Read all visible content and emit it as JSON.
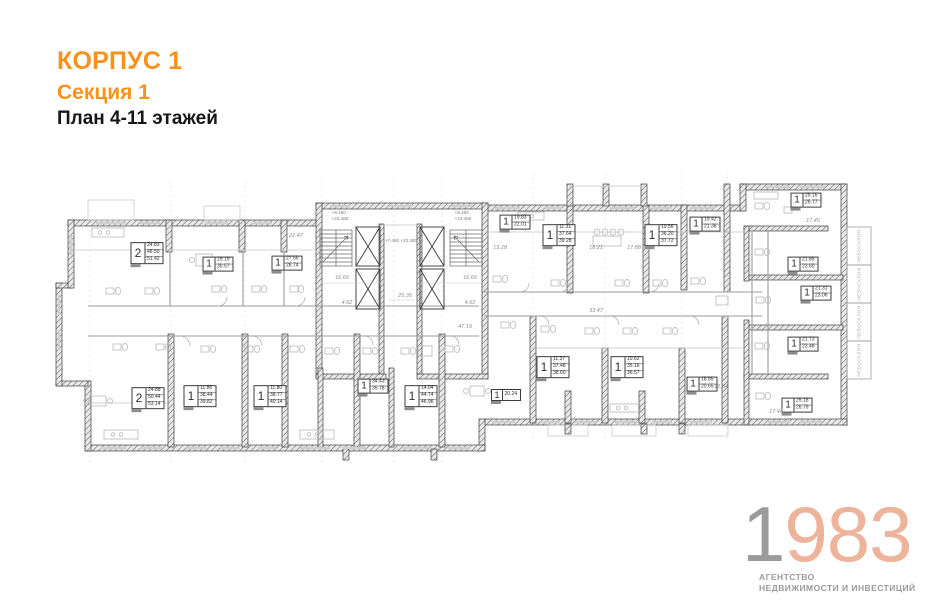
{
  "header": {
    "building": "КОРПУС 1",
    "section": "Секция 1",
    "plan_title": "План 4-11 этажей"
  },
  "logo": {
    "digit_gray": "1",
    "digits_accent": "983",
    "agency_line1": "АГЕНТСТВО",
    "agency_line2": "НЕДВИЖИМОСТИ И ИНВЕСТИЦИЙ"
  },
  "colors": {
    "accent_orange": "#F6921E",
    "logo_peach": "#EDB49B",
    "logo_gray": "#9B9B9B",
    "wall_gray": "#3F3F3F"
  },
  "plan": {
    "apartments": [
      {
        "rooms": "2",
        "areas": [
          "24.83",
          "48.50",
          "51.42"
        ],
        "x": 147,
        "y": 253
      },
      {
        "rooms": "1",
        "areas": [
          "29.19",
          "30.57"
        ],
        "x": 218,
        "y": 264
      },
      {
        "rooms": "1",
        "areas": [
          "27.55",
          "28.74"
        ],
        "x": 287,
        "y": 263
      },
      {
        "rooms": "1",
        "areas": [
          "19.83",
          "22.01"
        ],
        "x": 515,
        "y": 222
      },
      {
        "rooms": "1",
        "areas": [
          "11.31",
          "37.64",
          "39.28"
        ],
        "x": 559,
        "y": 235
      },
      {
        "rooms": "1",
        "areas": [
          "10.56",
          "36.20",
          "37.72"
        ],
        "x": 661,
        "y": 235
      },
      {
        "rooms": "1",
        "areas": [
          "19.42",
          "21.38"
        ],
        "x": 705,
        "y": 224
      },
      {
        "rooms": "1",
        "areas": [
          "25.16",
          "26.77"
        ],
        "x": 806,
        "y": 200
      },
      {
        "rooms": "1",
        "areas": [
          "21.85",
          "23.60"
        ],
        "x": 803,
        "y": 264
      },
      {
        "rooms": "1",
        "areas": [
          "21.31",
          "23.06"
        ],
        "x": 816,
        "y": 293
      },
      {
        "rooms": "1",
        "areas": [
          "21.73",
          "23.48"
        ],
        "x": 803,
        "y": 344
      },
      {
        "rooms": "1",
        "areas": [
          "25.18",
          "26.79"
        ],
        "x": 797,
        "y": 405
      },
      {
        "rooms": "2",
        "areas": [
          "24.88",
          "50.44",
          "53.14"
        ],
        "x": 148,
        "y": 398
      },
      {
        "rooms": "1",
        "areas": [
          "11.86",
          "38.44",
          "39.82"
        ],
        "x": 200,
        "y": 396
      },
      {
        "rooms": "1",
        "areas": [
          "11.80",
          "38.77",
          "40.14"
        ],
        "x": 270,
        "y": 396
      },
      {
        "rooms": "1",
        "areas": [
          "34.43",
          "35.78"
        ],
        "x": 373,
        "y": 386
      },
      {
        "rooms": "1",
        "areas": [
          "14.04",
          "44.74",
          "46.96"
        ],
        "x": 421,
        "y": 396
      },
      {
        "rooms": "1",
        "areas": [
          "20.24"
        ],
        "x": 506,
        "y": 395
      },
      {
        "rooms": "1",
        "areas": [
          "11.37",
          "37.48",
          "38.60"
        ],
        "x": 553,
        "y": 367
      },
      {
        "rooms": "1",
        "areas": [
          "10.62",
          "35.16",
          "36.57"
        ],
        "x": 627,
        "y": 367
      },
      {
        "rooms": "1",
        "areas": [
          "18.85",
          "20.65"
        ],
        "x": 702,
        "y": 384
      }
    ],
    "dimensions": [
      {
        "text": "16.66",
        "x": 342,
        "y": 278
      },
      {
        "text": "16.66",
        "x": 470,
        "y": 278
      },
      {
        "text": "25.35",
        "x": 405,
        "y": 296
      },
      {
        "text": "4.62",
        "x": 347,
        "y": 303
      },
      {
        "text": "4.62",
        "x": 470,
        "y": 303
      },
      {
        "text": "47.19",
        "x": 465,
        "y": 327
      },
      {
        "text": "33.47",
        "x": 596,
        "y": 311
      },
      {
        "text": "21.47",
        "x": 296,
        "y": 236
      },
      {
        "text": "13.28",
        "x": 500,
        "y": 248
      },
      {
        "text": "18.21",
        "x": 596,
        "y": 248
      },
      {
        "text": "17.88",
        "x": 634,
        "y": 248
      },
      {
        "text": "17.45",
        "x": 813,
        "y": 221
      },
      {
        "text": "12.64",
        "x": 721,
        "y": 387
      },
      {
        "text": "17.44",
        "x": 776,
        "y": 412
      }
    ],
    "elevations": [
      {
        "lines": [
          "+8.460",
          "+23.460"
        ],
        "x": 340,
        "y": 216
      },
      {
        "lines": [
          "+8.460",
          "+23.460"
        ],
        "x": 463,
        "y": 216
      },
      {
        "lines": [
          "+7.460  +23.380"
        ],
        "x": 401,
        "y": 241
      }
    ],
    "balcony_label": "небосклон",
    "balconies": [
      {
        "x": 859,
        "y": 246
      },
      {
        "x": 859,
        "y": 284
      },
      {
        "x": 859,
        "y": 322
      },
      {
        "x": 859,
        "y": 360
      }
    ]
  }
}
